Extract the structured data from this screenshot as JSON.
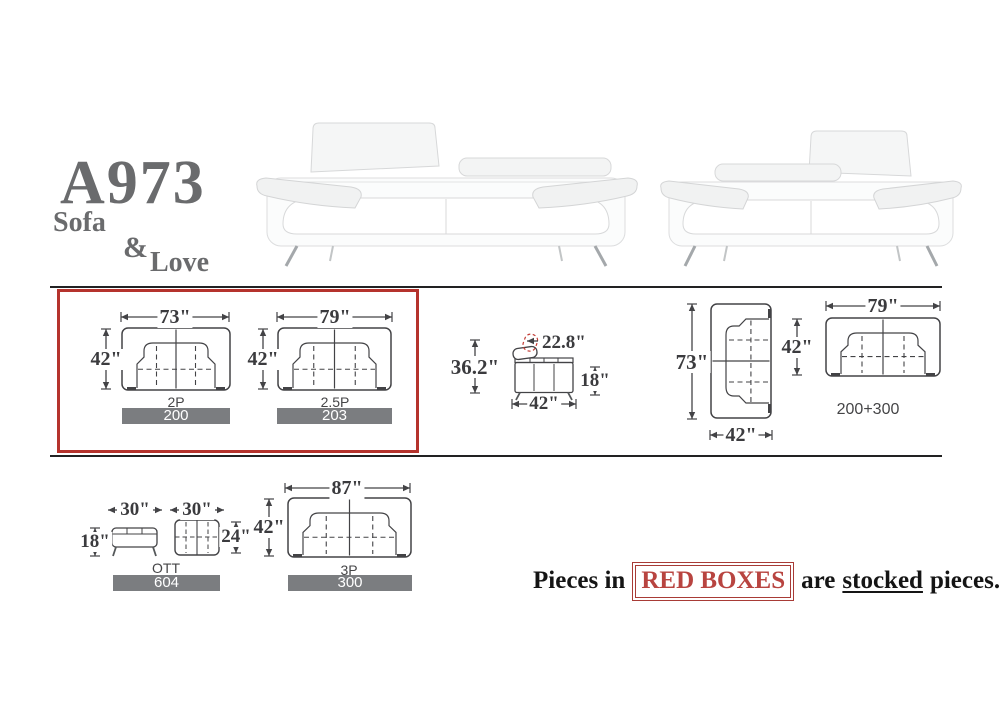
{
  "title": {
    "model": "A973",
    "word1": "Sofa",
    "amp": "&",
    "word2": "Love"
  },
  "colors": {
    "accent_red": "#b5332d",
    "bar_gray": "#7b7d80",
    "title_gray": "#6a6b6d"
  },
  "stock_note": {
    "prefix": "Pieces in",
    "boxed": "RED BOXES",
    "mid": "are",
    "underlined": "stocked",
    "suffix": "pieces."
  },
  "diagrams": {
    "two_seat": {
      "label": "2P",
      "code": "200",
      "width": "73\"",
      "depth": "42\""
    },
    "two_half_seat": {
      "label": "2.5P",
      "code": "203",
      "width": "79\"",
      "depth": "42\""
    },
    "side_view": {
      "total_height": "36.2\"",
      "headrest_height": "22.8\"",
      "seat_height": "18\"",
      "depth": "42\""
    },
    "sofa_rotated": {
      "length": "73\"",
      "depth": "42\""
    },
    "loveseat_top": {
      "width": "79\"",
      "depth": "42\"",
      "combo": "200+300"
    },
    "ottoman": {
      "label": "OTT",
      "code": "604",
      "side_width": "30\"",
      "height": "18\"",
      "top_width": "30\"",
      "top_depth": "24\""
    },
    "three_seat": {
      "label": "3P",
      "code": "300",
      "width": "87\"",
      "depth": "42\""
    }
  }
}
